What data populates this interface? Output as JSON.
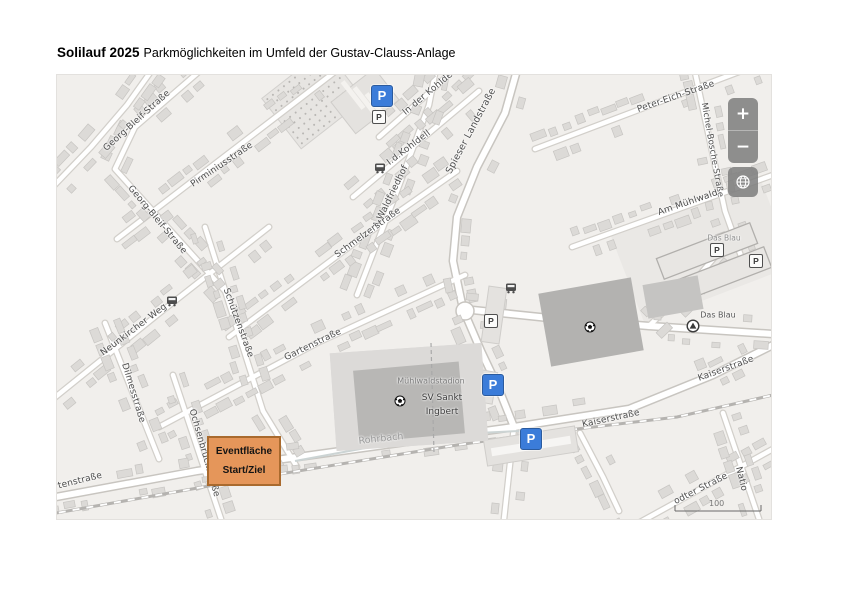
{
  "title": {
    "bold": "Solilauf 2025",
    "rest": "Parkmöglichkeiten im Umfeld der Gustav-Clauss-Anlage"
  },
  "colors": {
    "parking_blue": "#3b7cd9",
    "event_fill": "#e5965a",
    "event_border": "#a96a2e",
    "map_background": "#f1efec"
  },
  "map": {
    "street_labels": [
      {
        "text": "Georg-Bleif-Straße"
      },
      {
        "text": "Georg-Bleif-Straße"
      },
      {
        "text": "Pirminiusstraße"
      },
      {
        "text": "In der Kohldell"
      },
      {
        "text": "I.d.Kohldell"
      },
      {
        "text": "Spieser Landstraße"
      },
      {
        "text": "A.Waldfriedhof"
      },
      {
        "text": "Schmelzerstraße"
      },
      {
        "text": "Peter-Eich-Straße"
      },
      {
        "text": "Michel-Bosche-Straße"
      },
      {
        "text": "Am Mühlwald"
      },
      {
        "text": "Neunkircher Weg"
      },
      {
        "text": "Schützenstraße"
      },
      {
        "text": "Dilmesstraße"
      },
      {
        "text": "Gartenstraße"
      },
      {
        "text": "Ochsenbrückstraße"
      },
      {
        "text": "Gartenstraße"
      },
      {
        "text": "Kaiserstraße"
      },
      {
        "text": "Kaiserstraße"
      },
      {
        "text": "odter Straße"
      },
      {
        "text": "Natio"
      }
    ],
    "poi": {
      "stadium": "Mühlwaldstadion",
      "club_line1": "SV Sankt",
      "club_line2": "Ingbert",
      "river": "Rohrbach",
      "das_blau_upper": "Das Blau",
      "das_blau_lower": "Das Blau"
    },
    "parking_label": "P",
    "scale_label": "100"
  },
  "event_box": {
    "line1": "Eventfläche",
    "line2": "Start/Ziel"
  },
  "zoom_controls": {
    "zoom_in": "+",
    "zoom_out": "−"
  }
}
